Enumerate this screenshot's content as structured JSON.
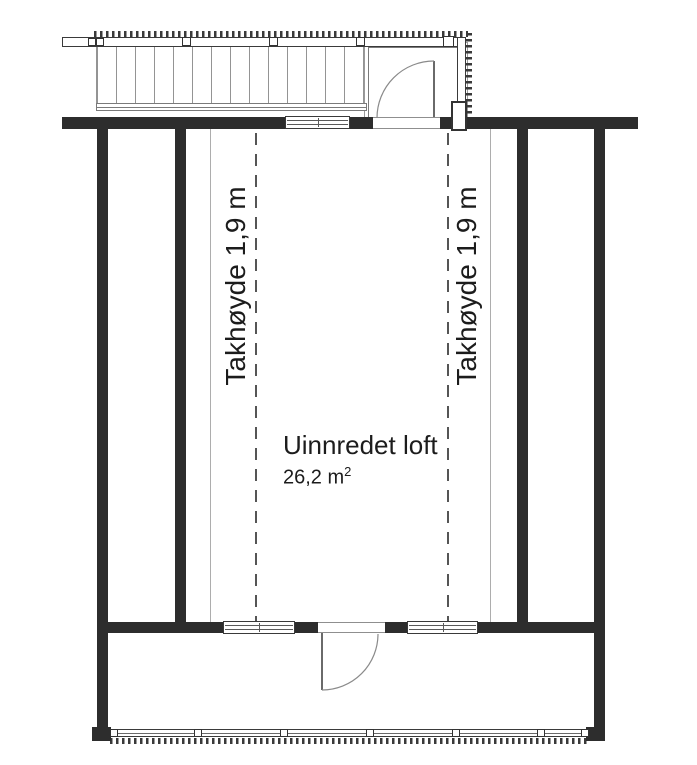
{
  "title": "Loft floor plan",
  "labels": {
    "ceiling_height_left": "Takhøyde 1,9 m",
    "ceiling_height_right": "Takhøyde 1,9 m",
    "room_name": "Uinnredet loft",
    "room_area": "26,2 m",
    "room_area_sup": "2"
  },
  "colors": {
    "wall": "#2d2d2d",
    "line_dark": "#3a3a3a",
    "line_mid": "#6a6a6a",
    "line_light": "#949494",
    "text": "#1c1c1c",
    "background": "#ffffff"
  }
}
